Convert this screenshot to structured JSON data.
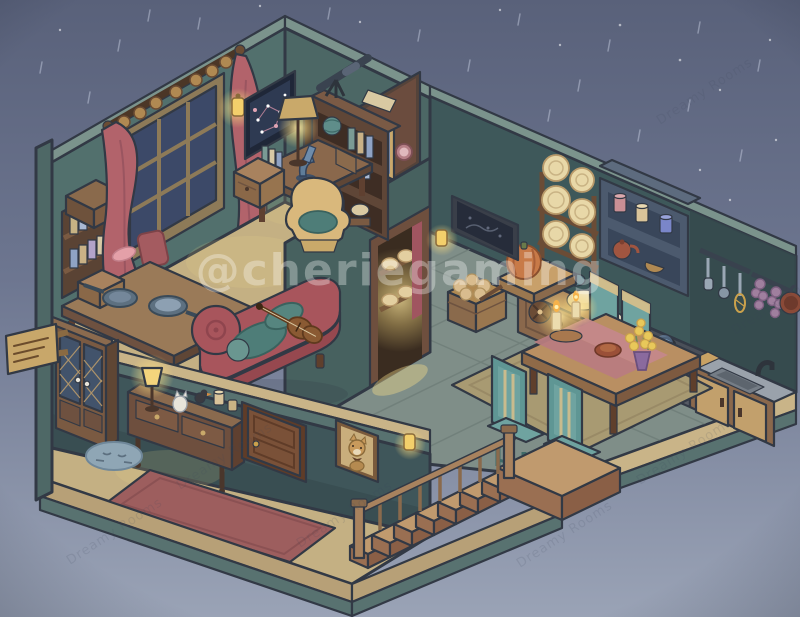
{
  "scene": {
    "description": "Isometric cutaway dollhouse at night in the rain: upstairs study with telescope and violin chaise, kitchen with dining table, downstairs hallway with staircase",
    "watermark": {
      "handle": "@cheriegaming",
      "studio": "Dreamy Rooms"
    },
    "palette": {
      "sky_top": "#59617a",
      "sky_bottom": "#9aa3b6",
      "wall_teal": "#52706d",
      "wall_teal_front": "#47615f",
      "wall_cut": "#7b938c",
      "kitchen_wall": "#3e585a",
      "brown_wall": "#6b4c3e",
      "hall_wall": "#3f565a",
      "floor_wood": "#c4b083",
      "floor_tile": "#7f8e88",
      "slab_tan": "#c9b488",
      "slab_teal": "#587270",
      "rug_red": "#9d5e5e",
      "rug_dining": "#a89a72",
      "chaise_red": "#a8555c",
      "bolster_teal": "#4e7d78",
      "chair_teal": "#6fa3a0",
      "wood": "#8a6a4c",
      "wood_dark": "#6e4f3e",
      "curtain_rose": "#b2636b",
      "glow": "#f6d980",
      "outline": "#323945"
    },
    "rooms": {
      "study": {
        "items": [
          "wall-bookshelf",
          "window",
          "curtains",
          "wall-sconce",
          "constellation-chart",
          "bookcase",
          "telescope",
          "globe",
          "desk-lamp",
          "microscope-desk",
          "armchair",
          "drawer-box",
          "work-table",
          "frying-pans",
          "bread-box",
          "red-chair",
          "chaise-lounge",
          "violin",
          "bolster-pillows"
        ]
      },
      "back_room": {
        "items": [
          "mirror",
          "wall-clocks",
          "red-bench",
          "book-stack"
        ]
      },
      "kitchen": {
        "items": [
          "plate-rack",
          "wall-cabinet",
          "jars",
          "teapot",
          "basket",
          "utensil-rail",
          "spatula",
          "ladle",
          "whisk",
          "garlic-strings",
          "hanging-pan",
          "stove",
          "blue-flame",
          "sink",
          "faucet",
          "cabinet-doors",
          "cutting-board",
          "mixing-bowl",
          "teal-bowls",
          "bread-loaf",
          "pumpkin",
          "pumpkin-cart",
          "potato-crate",
          "pantry-doorway",
          "bread-shelves",
          "wall-painting",
          "wall-sconce"
        ]
      },
      "dining": {
        "items": [
          "dining-table",
          "table-runner",
          "candles",
          "pie",
          "flower-vase",
          "dining-chairs",
          "area-rug"
        ]
      },
      "hallway": {
        "items": [
          "wardrobe",
          "console-table",
          "table-lamp",
          "cat-figurine",
          "bird-figurine",
          "jars",
          "door",
          "fox-portrait",
          "wall-sconce",
          "cat-doormat",
          "red-rug",
          "staircase",
          "railing",
          "landing"
        ]
      },
      "exterior": {
        "items": [
          "house-sign",
          "cut-walls",
          "floor-slabs",
          "rain",
          "stars"
        ]
      }
    }
  }
}
